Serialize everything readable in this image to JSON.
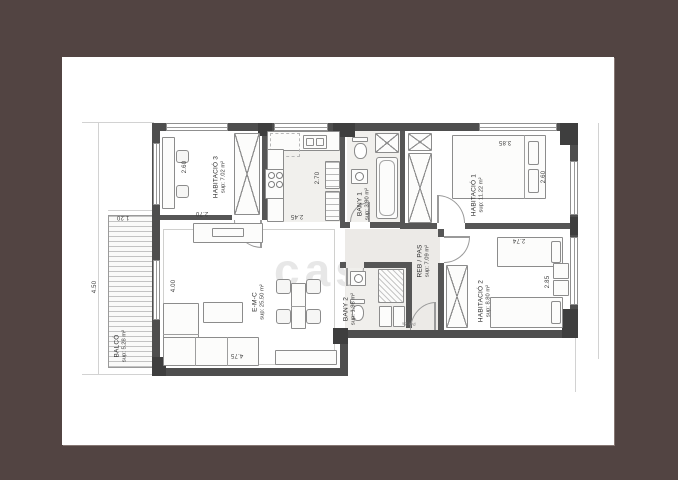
{
  "watermark_text": "casa",
  "rooms": {
    "habitacio3": {
      "name": "HABITACIÓ 3",
      "area": "sup: 7.02 m²"
    },
    "habitacio1": {
      "name": "HABITACIÓ 1",
      "area": "sup: 11.22 m²"
    },
    "habitacio2": {
      "name": "HABITACIÓ 2",
      "area": "sup: 8.80 m²"
    },
    "bany1": {
      "name": "BANY 1",
      "area": "sup: 3.90 m²"
    },
    "bany2": {
      "name": "BANY 2",
      "area": "sup: 1.98 m²"
    },
    "rebpas": {
      "name": "REB / PAS",
      "area": "sup: 7.09 m²"
    },
    "emc": {
      "name": "E-M-C",
      "area": "sup: 25.50 m²"
    },
    "balco": {
      "name": "BALCÓ",
      "area": "sup: 5.28 m²"
    }
  },
  "dims": {
    "hab3_w": "2.60",
    "hab3_d": "2.70",
    "kitchen_d": "2.70",
    "kitchen_w": "2.45",
    "hab1_w": "3.85",
    "hab1_d": "2.60",
    "hab2_w": "2.74",
    "hab2_d": "2.85",
    "emc_d": "4.00",
    "emc_w": "4.75",
    "balco_d": "4.50",
    "balco_w": "1.20"
  },
  "labels": {
    "entry_door": "Por 2a"
  },
  "colors": {
    "frame": "#524442",
    "wall": "#4e4e4e",
    "sheet": "#ffffff"
  }
}
